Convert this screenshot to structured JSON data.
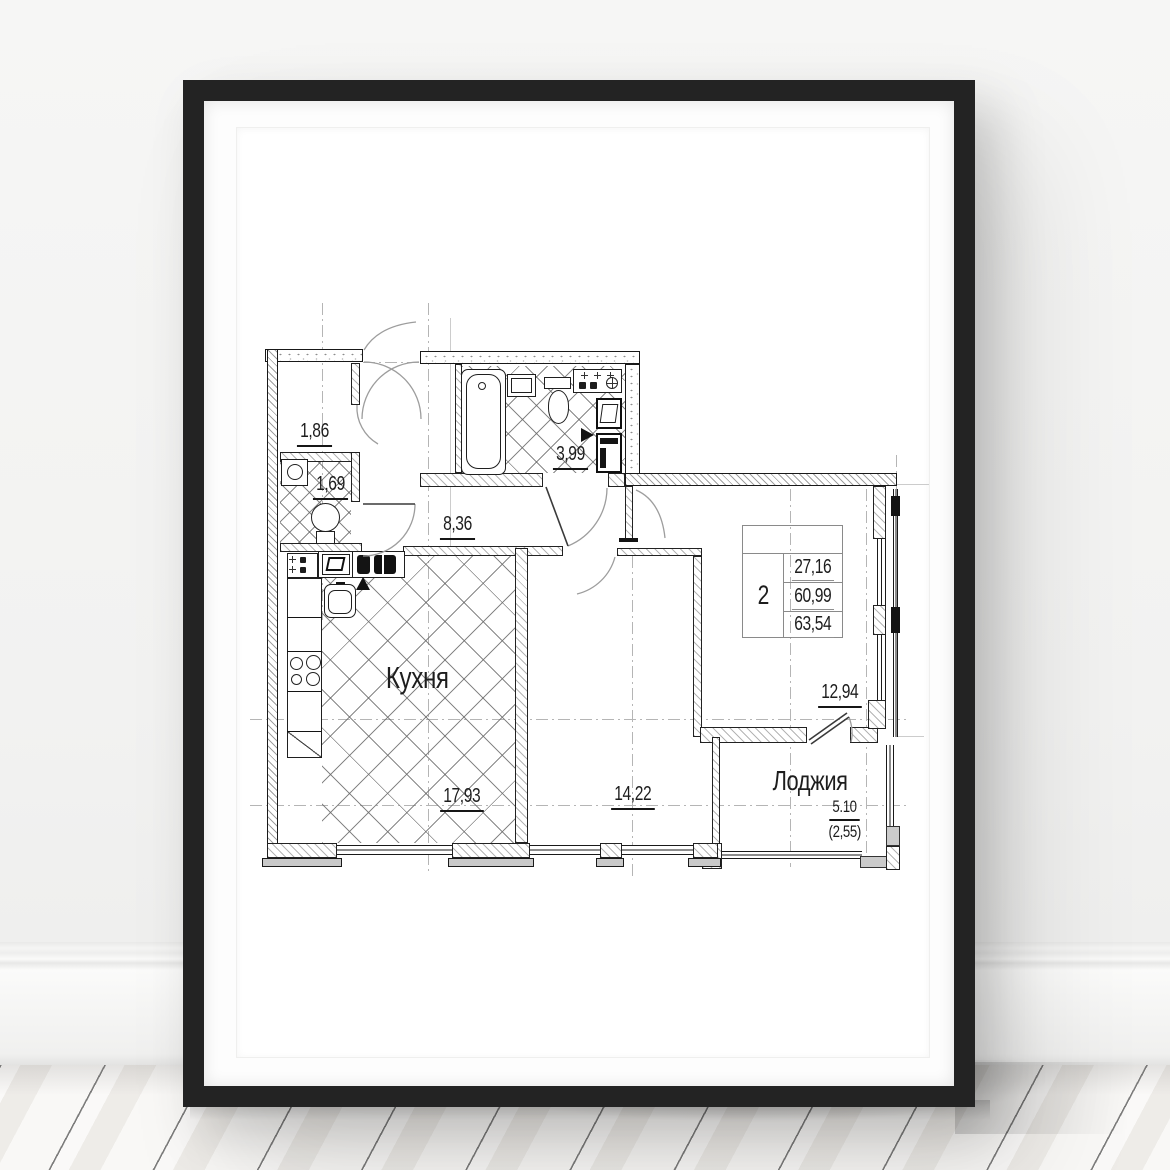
{
  "plan": {
    "labels": {
      "entry_area": "1,86",
      "wc_area": "1,69",
      "bathroom_area": "3,99",
      "hallway_area": "8,36",
      "kitchen_name": "Кухня",
      "kitchen_area": "17,93",
      "living_room_area": "14,22",
      "bedroom_area": "12,94",
      "loggia_name": "Лоджия",
      "loggia_area_full": "5.10",
      "loggia_area_reduced": "(2,55)"
    },
    "summary": {
      "rooms_count": "2",
      "values": [
        "27,16",
        "60,99",
        "63,54"
      ]
    }
  },
  "colors": {
    "frame": "#232323",
    "ink": "#1a1a1a",
    "hatch": "#8f8f8f",
    "reference_line": "#b5b5b5",
    "floor_seam": "#3d3d3d"
  }
}
